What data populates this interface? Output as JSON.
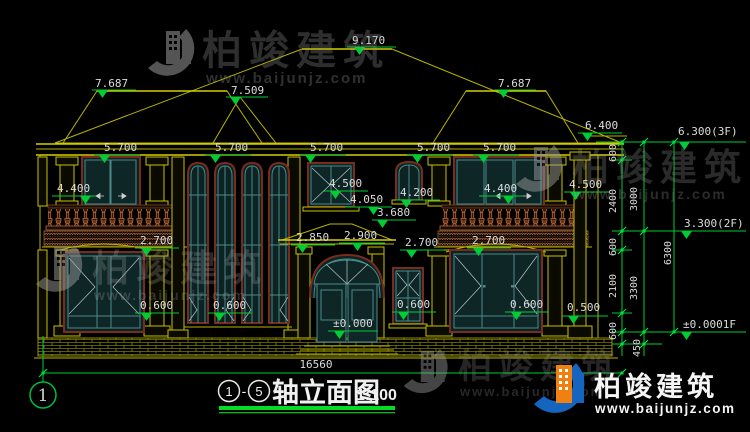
{
  "watermark": {
    "brand": "柏竣建筑",
    "url": "www.baijunjz.com"
  },
  "logo": {
    "brand": "柏竣建筑",
    "url": "www.baijunjz.com"
  },
  "drawing_title": {
    "axis_start": "1",
    "dash": "-",
    "axis_end": "5",
    "name": "轴立面图",
    "scale": "1:100"
  },
  "axis_bubble_label": "1",
  "dimensions": {
    "total_width": "16560",
    "levels": [
      {
        "text": "9.170",
        "tx": 352,
        "ty": 44,
        "x1": 347,
        "x2": 396,
        "ly": 47,
        "trx": 354
      },
      {
        "text": "7.687",
        "tx": 95,
        "ty": 87,
        "x1": 92,
        "x2": 136,
        "ly": 90,
        "trx": 97
      },
      {
        "text": "7.509",
        "tx": 231,
        "ty": 94,
        "x1": 226,
        "x2": 268,
        "ly": 97,
        "trx": 230
      },
      {
        "text": "7.687",
        "tx": 498,
        "ty": 87,
        "x1": 494,
        "x2": 536,
        "ly": 90,
        "trx": 498
      },
      {
        "text": "6.400",
        "tx": 585,
        "ty": 129,
        "x1": 578,
        "x2": 622,
        "ly": 133,
        "trx": 582
      },
      {
        "text": "6.300(3F)",
        "tx": 678,
        "ty": 135,
        "x1": 674,
        "x2": 744,
        "ly": 142,
        "trx": 679
      },
      {
        "text": "5.700",
        "tx": 104,
        "ty": 151,
        "x1": 94,
        "x2": 140,
        "ly": 155,
        "trx": 99
      },
      {
        "text": "5.700",
        "tx": 215,
        "ty": 151,
        "x1": 205,
        "x2": 251,
        "ly": 155,
        "trx": 210
      },
      {
        "text": "5.700",
        "tx": 310,
        "ty": 151,
        "x1": 300,
        "x2": 346,
        "ly": 155,
        "trx": 305
      },
      {
        "text": "5.700",
        "tx": 417,
        "ty": 151,
        "x1": 407,
        "x2": 453,
        "ly": 155,
        "trx": 412
      },
      {
        "text": "5.700",
        "tx": 483,
        "ty": 151,
        "x1": 473,
        "x2": 519,
        "ly": 155,
        "trx": 478
      },
      {
        "text": "4.400",
        "tx": 57,
        "ty": 192,
        "x1": 52,
        "x2": 96,
        "ly": 196,
        "trx": 80
      },
      {
        "text": "4.500",
        "tx": 329,
        "ty": 187,
        "x1": 324,
        "x2": 368,
        "ly": 191,
        "trx": 330
      },
      {
        "text": "4.050",
        "tx": 350,
        "ty": 203,
        "x1": 345,
        "x2": 392,
        "ly": 207,
        "trx": 368
      },
      {
        "text": "4.200",
        "tx": 400,
        "ty": 196,
        "x1": 396,
        "x2": 440,
        "ly": 200,
        "trx": 401
      },
      {
        "text": "4.400",
        "tx": 484,
        "ty": 192,
        "x1": 479,
        "x2": 523,
        "ly": 196,
        "trx": 503
      },
      {
        "text": "4.500",
        "tx": 569,
        "ty": 188,
        "x1": 564,
        "x2": 610,
        "ly": 192,
        "trx": 570
      },
      {
        "text": "3.680",
        "tx": 377,
        "ty": 216,
        "x1": 372,
        "x2": 416,
        "ly": 220,
        "trx": 377
      },
      {
        "text": "2.850",
        "tx": 296,
        "ty": 241,
        "x1": 291,
        "x2": 335,
        "ly": 245,
        "trx": 297
      },
      {
        "text": "2.900",
        "tx": 344,
        "ty": 239,
        "x1": 339,
        "x2": 385,
        "ly": 243,
        "trx": 352
      },
      {
        "text": "2.700",
        "tx": 140,
        "ty": 244,
        "x1": 135,
        "x2": 179,
        "ly": 248,
        "trx": 141
      },
      {
        "text": "2.700",
        "tx": 405,
        "ty": 246,
        "x1": 400,
        "x2": 444,
        "ly": 250,
        "trx": 406
      },
      {
        "text": "2.700",
        "tx": 472,
        "ty": 244,
        "x1": 467,
        "x2": 511,
        "ly": 248,
        "trx": 473
      },
      {
        "text": "0.600",
        "tx": 140,
        "ty": 309,
        "x1": 135,
        "x2": 179,
        "ly": 313,
        "trx": 141
      },
      {
        "text": "0.600",
        "tx": 213,
        "ty": 309,
        "x1": 208,
        "x2": 252,
        "ly": 313,
        "trx": 214
      },
      {
        "text": "0.600",
        "tx": 397,
        "ty": 308,
        "x1": 392,
        "x2": 436,
        "ly": 312,
        "trx": 398
      },
      {
        "text": "0.600",
        "tx": 510,
        "ty": 308,
        "x1": 505,
        "x2": 549,
        "ly": 312,
        "trx": 511
      },
      {
        "text": "0.500",
        "tx": 567,
        "ty": 311,
        "x1": 562,
        "x2": 608,
        "ly": 316,
        "trx": 568
      },
      {
        "text": "±0.000",
        "tx": 333,
        "ty": 327,
        "x1": 328,
        "x2": 378,
        "ly": 331,
        "trx": 334
      },
      {
        "text": "3.300(2F)",
        "tx": 684,
        "ty": 227,
        "x1": 676,
        "x2": 744,
        "ly": 231,
        "trx": 681
      },
      {
        "text": "±0.0001F",
        "tx": 683,
        "ty": 328,
        "x1": 676,
        "x2": 744,
        "ly": 332,
        "trx": 681
      }
    ],
    "vertical": [
      {
        "text": "600",
        "x": 616,
        "y": 153
      },
      {
        "text": "2400",
        "x": 616,
        "y": 201
      },
      {
        "text": "600",
        "x": 616,
        "y": 247
      },
      {
        "text": "2100",
        "x": 616,
        "y": 286
      },
      {
        "text": "600",
        "x": 616,
        "y": 331
      },
      {
        "text": "3000",
        "x": 637,
        "y": 199
      },
      {
        "text": "3300",
        "x": 637,
        "y": 288
      },
      {
        "text": "450",
        "x": 640,
        "y": 348
      },
      {
        "text": "6300",
        "x": 671,
        "y": 253
      }
    ]
  },
  "colors": {
    "background": "#000000",
    "dimension_green": "#00cc33",
    "line_yellow": "#b9b400",
    "window_teal": "#4a8a8a",
    "frame_brown": "#7a2c1c",
    "baluster_orange": "#b06838",
    "text_white": "#dcdcdc",
    "logo_blue": "#1565c0",
    "logo_orange": "#f08010",
    "title_underline_green": "#00dd22"
  }
}
